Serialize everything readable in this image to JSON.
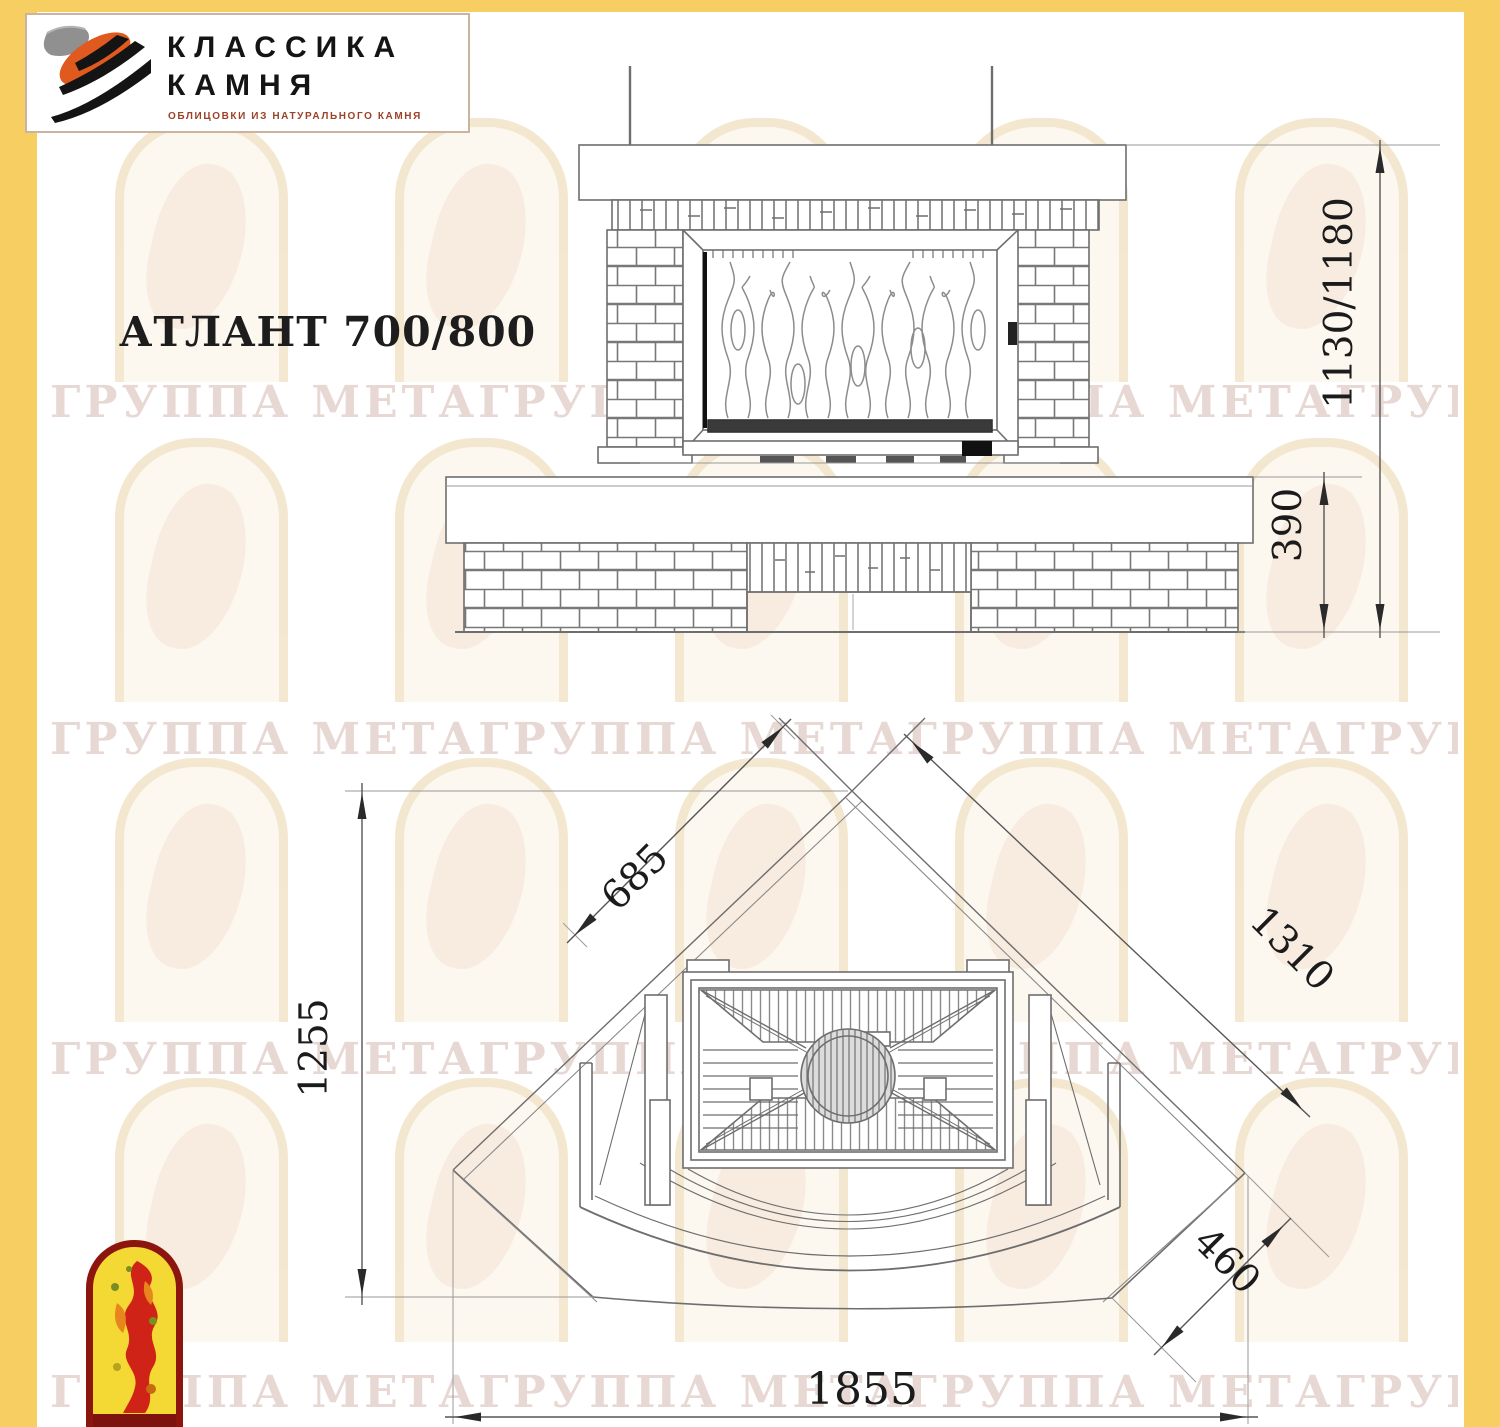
{
  "logo": {
    "line1": "КЛАССИКА",
    "line2": "КАМНЯ",
    "tagline": "ОБЛИЦОВКИ ИЗ НАТУРАЛЬНОГО КАМНЯ"
  },
  "title": "АТЛАНТ 700/800",
  "watermark": {
    "row_text": "ГРУППА МЕТАГРУППА МЕТАГРУППА МЕТАГРУППА МЕТА"
  },
  "front_view": {
    "height_label": "1130/1180",
    "base_height_label": "390"
  },
  "plan_view": {
    "depth_label": "1255",
    "side_wall_label": "685",
    "diagonal_label": "1310",
    "corner_label": "460",
    "total_width_label": "1855"
  },
  "icons": {
    "stone_logo_graphic": "stone-brush-strokes",
    "emblem_graphic": "firebird-arch"
  },
  "colors": {
    "frame_yellow": "#F7CE62",
    "logo_orange": "#E0591E",
    "emblem_red": "#CF2318",
    "emblem_yellow": "#F4D934",
    "watermark_pink": "#C89E94",
    "drawing_line": "#6E6E6E"
  }
}
